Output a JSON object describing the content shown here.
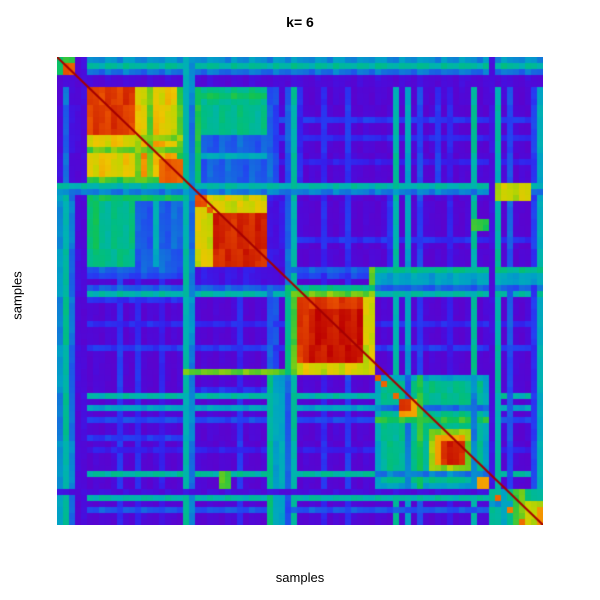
{
  "title": "k= 6",
  "x_axis_label": "samples",
  "y_axis_label": "samples",
  "chart_data": {
    "type": "heatmap",
    "title": "k= 6",
    "xlabel": "samples",
    "ylabel": "samples",
    "legend": "none",
    "axes_ticks": "none",
    "description": "Consensus matrix heatmap for k=6 clusters. Samples ordered identically on both axes; red diagonal line of self-consensus. Six diagonal cluster blocks: (1) tiny green-bordered red block at top-left; (2) large red block with orange/yellow striped right half; (3) red block with small leading red squares; (4) red block with green/yellow fringe; (5) diffuse green zone with small red blocks and an orange/red blob; (6) mixed green/orange corner block. Violet/purple low-consensus background crosshatched with blue and cyan/green streak lines, plus green inter-cluster blocks.",
    "value_range": [
      0,
      1
    ],
    "colormap_stops": [
      [
        0.0,
        "#5a03ce"
      ],
      [
        0.08,
        "#4b0bdb"
      ],
      [
        0.16,
        "#3420ec"
      ],
      [
        0.24,
        "#2440f2"
      ],
      [
        0.32,
        "#1668e0"
      ],
      [
        0.4,
        "#009fc8"
      ],
      [
        0.48,
        "#00b2b2"
      ],
      [
        0.56,
        "#00bd85"
      ],
      [
        0.64,
        "#10c353"
      ],
      [
        0.72,
        "#67cb1d"
      ],
      [
        0.8,
        "#c3d400"
      ],
      [
        0.86,
        "#eec400"
      ],
      [
        0.91,
        "#f49400"
      ],
      [
        0.96,
        "#e84e00"
      ],
      [
        1.0,
        "#bd0000"
      ]
    ],
    "diagonal_color": "#a50000",
    "grid": {
      "cols": 81,
      "rows": 78,
      "cell_px": 6,
      "base_value": 0.03
    },
    "clusters_cell_ranges": [
      {
        "id": 1,
        "range": [
          0,
          3.4
        ]
      },
      {
        "id": 2,
        "range": [
          4.6,
          21.4
        ]
      },
      {
        "id": 3,
        "range": [
          23.2,
          34.6
        ]
      },
      {
        "id": 4,
        "range": [
          38.4,
          53.0
        ]
      },
      {
        "id": 5,
        "range": [
          53.0,
          71.5
        ]
      },
      {
        "id": 6,
        "range": [
          72.4,
          81.0
        ]
      }
    ],
    "paint": [
      {
        "t": "r",
        "x": [
          0,
          81
        ],
        "y": [
          9.5,
          10.2
        ],
        "v": 0.22,
        "s": 1
      },
      {
        "t": "r",
        "x": [
          0,
          81
        ],
        "y": [
          12.8,
          13.4
        ],
        "v": 0.18,
        "s": 1
      },
      {
        "t": "r",
        "x": [
          0,
          81
        ],
        "y": [
          17.0,
          17.5
        ],
        "v": 0.15,
        "s": 1
      },
      {
        "t": "r",
        "x": [
          0,
          81
        ],
        "y": [
          30.0,
          30.5
        ],
        "v": 0.2,
        "s": 1
      },
      {
        "t": "r",
        "x": [
          0,
          81
        ],
        "y": [
          36.0,
          36.5
        ],
        "v": 0.25,
        "s": 1
      },
      {
        "t": "r",
        "x": [
          0,
          81
        ],
        "y": [
          44.0,
          44.5
        ],
        "v": 0.18,
        "s": 1
      },
      {
        "t": "r",
        "x": [
          0,
          81
        ],
        "y": [
          47.5,
          48.0
        ],
        "v": 0.22,
        "s": 1
      },
      {
        "t": "r",
        "x": [
          0,
          81
        ],
        "y": [
          59.8,
          60.4
        ],
        "v": 0.25,
        "s": 1
      },
      {
        "t": "r",
        "x": [
          0,
          81
        ],
        "y": [
          65.0,
          65.5
        ],
        "v": 0.15,
        "s": 1
      },
      {
        "t": "r",
        "x": [
          0,
          81
        ],
        "y": [
          74.5,
          75.0
        ],
        "v": 0.2,
        "s": 1
      },
      {
        "t": "r",
        "x": [
          0,
          81
        ],
        "y": [
          55.8,
          56.8
        ],
        "v": 0.5,
        "s": 1
      },
      {
        "t": "r",
        "x": [
          0,
          81
        ],
        "y": [
          57.6,
          58.4
        ],
        "v": 0.42,
        "s": 1
      },
      {
        "t": "r",
        "x": [
          0,
          81
        ],
        "y": [
          73.3,
          74.1
        ],
        "v": 0.5,
        "s": 1
      },
      {
        "t": "r",
        "x": [
          0,
          81
        ],
        "y": [
          68.6,
          69.3
        ],
        "v": 0.52,
        "s": 1
      },
      {
        "t": "r",
        "x": [
          0,
          81
        ],
        "y": [
          80.3,
          81.0
        ],
        "v": 0.45,
        "s": 1
      },
      {
        "t": "r",
        "x": [
          0,
          81
        ],
        "y": [
          39.3,
          39.9
        ],
        "v": 0.5,
        "s": 1
      },
      {
        "t": "r",
        "x": [
          0,
          81
        ],
        "y": [
          34.6,
          35.1
        ],
        "v": 0.3,
        "s": 1
      },
      {
        "t": "r",
        "x": [
          0,
          81
        ],
        "y": [
          38.4,
          38.9
        ],
        "v": 0.3,
        "s": 1
      },
      {
        "t": "r",
        "x": [
          75.3,
          75.9
        ],
        "y": [
          0,
          72.4
        ],
        "v": 0.28,
        "s": 1
      },
      {
        "t": "r",
        "x": [
          78.6,
          79.2
        ],
        "y": [
          0,
          72.4
        ],
        "v": 0.22,
        "s": 1
      },
      {
        "t": "r",
        "x": [
          4.6,
          21.4
        ],
        "y": [
          40.0,
          40.6
        ],
        "v": 0.2,
        "s": 1
      },
      {
        "t": "r",
        "x": [
          4.6,
          21.4
        ],
        "y": [
          63.0,
          63.6
        ],
        "v": 0.22,
        "s": 1
      },
      {
        "t": "r",
        "x": [
          23.2,
          34.6
        ],
        "y": [
          55.0,
          55.6
        ],
        "v": 0.2,
        "s": 1
      },
      {
        "t": "r",
        "x": [
          0,
          81
        ],
        "y": [
          0.0,
          0.8
        ],
        "v": 0.38,
        "s": 1
      },
      {
        "t": "r",
        "x": [
          0,
          81
        ],
        "y": [
          0.8,
          1.6
        ],
        "v": 0.52,
        "s": 1
      },
      {
        "t": "r",
        "x": [
          0,
          81
        ],
        "y": [
          1.6,
          2.4
        ],
        "v": 0.12,
        "s": 1
      },
      {
        "t": "r",
        "x": [
          0,
          81
        ],
        "y": [
          2.4,
          3.3
        ],
        "v": 0.33,
        "s": 1
      },
      {
        "t": "r",
        "x": [
          0,
          81
        ],
        "y": [
          3.4,
          4.6
        ],
        "v": 0.06,
        "s": 1
      },
      {
        "t": "r",
        "x": [
          0,
          3.5
        ],
        "y": [
          5,
          21.4
        ],
        "v": 0.07,
        "s": 0
      },
      {
        "t": "r",
        "x": [
          1.2,
          1.8
        ],
        "y": [
          5,
          21.4
        ],
        "v": 0.32,
        "s": 0
      },
      {
        "t": "r",
        "x": [
          0,
          81
        ],
        "y": [
          21.4,
          22.3
        ],
        "v": 0.5,
        "s": 1
      },
      {
        "t": "r",
        "x": [
          0,
          81
        ],
        "y": [
          22.3,
          23.2
        ],
        "v": 0.35,
        "s": 1
      },
      {
        "t": "r",
        "x": [
          73.0,
          78.5
        ],
        "y": [
          21.0,
          23.5
        ],
        "v": 0.8,
        "s": 0
      },
      {
        "t": "r",
        "x": [
          26.8,
          29.3
        ],
        "y": [
          68.8,
          71.6
        ],
        "v": 0.68,
        "s": 1
      },
      {
        "t": "r",
        "x": [
          4.6,
          13.0
        ],
        "y": [
          23.2,
          35.0
        ],
        "v": 0.55,
        "s": 1
      },
      {
        "t": "r",
        "x": [
          6.0,
          7.0
        ],
        "y": [
          23.2,
          35.0
        ],
        "v": 0.62,
        "s": 1
      },
      {
        "t": "r",
        "x": [
          13.0,
          21.4
        ],
        "y": [
          23.2,
          35.0
        ],
        "v": 0.3,
        "s": 1
      },
      {
        "t": "r",
        "x": [
          15.5,
          16.5
        ],
        "y": [
          23.2,
          35.0
        ],
        "v": 0.45,
        "s": 1
      },
      {
        "t": "r",
        "x": [
          4.6,
          21.4
        ],
        "y": [
          23.2,
          24.2
        ],
        "v": 0.62,
        "s": 1
      },
      {
        "t": "r",
        "x": [
          53,
          81
        ],
        "y": [
          34.6,
          38.4
        ],
        "v": 0.42,
        "s": 1
      },
      {
        "t": "r",
        "x": [
          53,
          81
        ],
        "y": [
          35.2,
          36.0
        ],
        "v": 0.55,
        "s": 1
      },
      {
        "t": "r",
        "x": [
          21.0,
          53.0
        ],
        "y": [
          52.0,
          53.4
        ],
        "v": 0.72,
        "s": 0
      },
      {
        "t": "r",
        "x": [
          52.0,
          53.4
        ],
        "y": [
          34.6,
          52.0
        ],
        "v": 0.68,
        "s": 0
      },
      {
        "t": "r",
        "x": [
          0,
          3.4
        ],
        "y": [
          0,
          3.4
        ],
        "v": 0.65,
        "s": 0
      },
      {
        "t": "r",
        "x": [
          0.7,
          2.9
        ],
        "y": [
          0.7,
          2.9
        ],
        "v": 0.95,
        "s": 0
      },
      {
        "t": "r",
        "x": [
          4.6,
          21.4
        ],
        "y": [
          4.6,
          21.4
        ],
        "v": 0.88,
        "s": 0
      },
      {
        "t": "r",
        "x": [
          4.6,
          13.0
        ],
        "y": [
          4.6,
          13.0
        ],
        "v": 0.97,
        "s": 0
      },
      {
        "t": "r",
        "x": [
          13.0,
          21.4
        ],
        "y": [
          4.6,
          13.0
        ],
        "v": 0.84,
        "s": 1
      },
      {
        "t": "r",
        "x": [
          14.8,
          15.6
        ],
        "y": [
          4.6,
          21.4
        ],
        "v": 0.72,
        "s": 1
      },
      {
        "t": "r",
        "x": [
          19.5,
          20.3
        ],
        "y": [
          4.6,
          21.4
        ],
        "v": 0.68,
        "s": 1
      },
      {
        "t": "r",
        "x": [
          13.0,
          14.0
        ],
        "y": [
          13.0,
          21.4
        ],
        "v": 0.75,
        "s": 1
      },
      {
        "t": "r",
        "x": [
          17.0,
          21.4
        ],
        "y": [
          17.0,
          21.4
        ],
        "v": 0.95,
        "s": 0
      },
      {
        "t": "r",
        "x": [
          23.2,
          34.6
        ],
        "y": [
          23.2,
          34.6
        ],
        "v": 0.82,
        "s": 0
      },
      {
        "t": "r",
        "x": [
          26.0,
          34.6
        ],
        "y": [
          26.0,
          34.6
        ],
        "v": 0.98,
        "s": 0
      },
      {
        "t": "r",
        "x": [
          23.2,
          24.6
        ],
        "y": [
          23.2,
          24.6
        ],
        "v": 0.96,
        "s": 0
      },
      {
        "t": "r",
        "x": [
          24.6,
          26.0
        ],
        "y": [
          24.6,
          26.0
        ],
        "v": 0.96,
        "s": 0
      },
      {
        "t": "r",
        "x": [
          23.2,
          34.6
        ],
        "y": [
          34.6,
          38.4
        ],
        "v": 0.12,
        "s": 1
      },
      {
        "t": "r",
        "x": [
          34.6,
          38.4
        ],
        "y": [
          34.6,
          38.4
        ],
        "v": 0.07,
        "s": 0
      },
      {
        "t": "r",
        "x": [
          38.4,
          53.0
        ],
        "y": [
          38.4,
          53.0
        ],
        "v": 0.72,
        "s": 0
      },
      {
        "t": "r",
        "x": [
          38.4,
          39.4
        ],
        "y": [
          38.4,
          53.0
        ],
        "v": 0.55,
        "s": 1
      },
      {
        "t": "r",
        "x": [
          40.4,
          51.4
        ],
        "y": [
          40.4,
          51.4
        ],
        "v": 0.97,
        "s": 0
      },
      {
        "t": "r",
        "x": [
          41.5,
          50.5
        ],
        "y": [
          41.5,
          50.5
        ],
        "v": 0.99,
        "s": 0
      },
      {
        "t": "r",
        "x": [
          51.4,
          53.0
        ],
        "y": [
          40.0,
          53.0
        ],
        "v": 0.82,
        "s": 1
      },
      {
        "t": "r",
        "x": [
          53.0,
          71.5
        ],
        "y": [
          53.0,
          71.5
        ],
        "v": 0.42,
        "s": 0
      },
      {
        "t": "r",
        "x": [
          53.5,
          70.5
        ],
        "y": [
          53.5,
          70.5
        ],
        "v": 0.55,
        "s": 0
      },
      {
        "t": "r",
        "x": [
          58.4,
          59.2
        ],
        "y": [
          53.0,
          71.5
        ],
        "v": 0.32,
        "s": 1
      },
      {
        "t": "r",
        "x": [
          60.3,
          61.0
        ],
        "y": [
          53.0,
          71.5
        ],
        "v": 0.65,
        "s": 1
      },
      {
        "t": "r",
        "x": [
          69.3,
          70.1
        ],
        "y": [
          53.0,
          71.5
        ],
        "v": 0.35,
        "s": 1
      },
      {
        "t": "r",
        "x": [
          53.2,
          54.0
        ],
        "y": [
          53.2,
          54.0
        ],
        "v": 0.95,
        "s": 0
      },
      {
        "t": "r",
        "x": [
          54.4,
          55.2
        ],
        "y": [
          54.4,
          55.2
        ],
        "v": 0.95,
        "s": 0
      },
      {
        "t": "r",
        "x": [
          55.6,
          56.4
        ],
        "y": [
          55.6,
          56.4
        ],
        "v": 0.95,
        "s": 0
      },
      {
        "t": "r",
        "x": [
          57.0,
          59.8
        ],
        "y": [
          57.0,
          59.8
        ],
        "v": 0.9,
        "s": 0
      },
      {
        "t": "r",
        "x": [
          57.4,
          59.4
        ],
        "y": [
          57.4,
          59.4
        ],
        "v": 0.97,
        "s": 0
      },
      {
        "t": "r",
        "x": [
          61.5,
          68.6
        ],
        "y": [
          61.5,
          68.6
        ],
        "v": 0.75,
        "s": 0
      },
      {
        "t": "r",
        "x": [
          62.8,
          68.2
        ],
        "y": [
          62.8,
          68.2
        ],
        "v": 0.9,
        "s": 0
      },
      {
        "t": "r",
        "x": [
          64.3,
          67.8
        ],
        "y": [
          64.3,
          67.8
        ],
        "v": 0.98,
        "s": 0
      },
      {
        "t": "r",
        "x": [
          70.0,
          71.5
        ],
        "y": [
          70.0,
          71.5
        ],
        "v": 0.9,
        "s": 0
      },
      {
        "t": "r",
        "x": [
          71.5,
          72.4
        ],
        "y": [
          0,
          78
        ],
        "v": 0.08,
        "s": 1
      },
      {
        "t": "r",
        "x": [
          72.4,
          81.0
        ],
        "y": [
          72.4,
          78.0
        ],
        "v": 0.55,
        "s": 0
      },
      {
        "t": "r",
        "x": [
          74.0,
          75.0
        ],
        "y": [
          72.4,
          78.0
        ],
        "v": 0.4,
        "s": 1
      },
      {
        "t": "r",
        "x": [
          76.0,
          77.5
        ],
        "y": [
          72.4,
          78.0
        ],
        "v": 0.7,
        "s": 0
      },
      {
        "t": "r",
        "x": [
          72.6,
          74.0
        ],
        "y": [
          72.6,
          74.0
        ],
        "v": 0.95,
        "s": 0
      },
      {
        "t": "r",
        "x": [
          78.0,
          81.0
        ],
        "y": [
          74.0,
          78.0
        ],
        "v": 0.8,
        "s": 0
      },
      {
        "t": "r",
        "x": [
          79.5,
          81.0
        ],
        "y": [
          75.0,
          78.0
        ],
        "v": 0.92,
        "s": 0
      },
      {
        "t": "r",
        "x": [
          74.5,
          75.5
        ],
        "y": [
          74.5,
          75.5
        ],
        "v": 0.93,
        "s": 0
      },
      {
        "t": "r",
        "x": [
          76.5,
          77.5
        ],
        "y": [
          76.5,
          77.5
        ],
        "v": 0.93,
        "s": 0
      }
    ]
  }
}
